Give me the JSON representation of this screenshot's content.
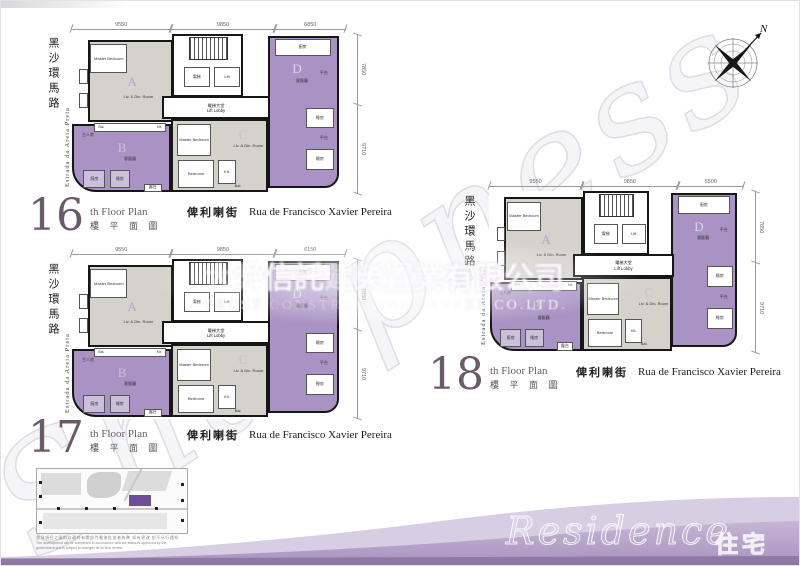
{
  "watermark": {
    "script_text": "Sharpness",
    "company_cn_pre": "大舜",
    "company_cn_a": "信託",
    "company_cn_mid": "建榮置業",
    "company_cn_b": "有限公司",
    "company_en_a": "TRUST",
    "company_en_mid": " CONSTRUCTION INVE",
    "company_en_b": "ST CO.LTD."
  },
  "compass": {
    "north_label": "N"
  },
  "plan_labels": {
    "unit_a": "A",
    "unit_b": "B",
    "unit_c": "C",
    "unit_d": "D",
    "master_bedroom": "Master Bedroom",
    "liv_din": "Liv. & Din. Room",
    "bedroom": "Bedroom",
    "kitchen_abbr": "Kit.",
    "balcony_abbr": "Bal.",
    "lift_cn": "電梯",
    "lift_en": "Lift",
    "lift_lobby_cn": "電梯大堂",
    "lift_lobby_en": "Lift Lobby",
    "living_dining_cn": "客飯廳",
    "master_room_cn": "主人房",
    "bedroom_cn": "睡房",
    "kitchen_cn": "廚房",
    "terrace_cn": "平台",
    "balcony_cn": "露台"
  },
  "floors": [
    {
      "number": "16",
      "suffix": "th Floor Plan",
      "title_cn": "樓 平 面 圖",
      "road_cn": "黑沙環馬路",
      "road_pt": "Estrada da Areia Preta",
      "street_cn": "俾利喇街",
      "street_pt": "Rua de Francisco Xavier Pereira",
      "dims_top": [
        "9550",
        "9850",
        "6850"
      ],
      "dims_right": [
        "7850",
        "9710"
      ]
    },
    {
      "number": "17",
      "suffix": "th Floor Plan",
      "title_cn": "樓 平 面 圖",
      "road_cn": "黑沙環馬路",
      "road_pt": "Estrada da Areia Preta",
      "street_cn": "俾利喇街",
      "street_pt": "Rua de Francisco Xavier Pereira",
      "dims_top": [
        "9550",
        "9850",
        "6150"
      ],
      "dims_right": [
        "7850",
        "9710"
      ]
    },
    {
      "number": "18",
      "suffix": "th Floor Plan",
      "title_cn": "樓 平 面 圖",
      "road_cn": "黑沙環馬路",
      "road_pt": "Estrada da Areia Preta",
      "street_cn": "俾利喇街",
      "street_pt": "Rua de Francisco Xavier Pereira",
      "dims_top": [
        "9550",
        "9850",
        "5500"
      ],
      "dims_right": [
        "7850",
        "9710"
      ]
    }
  ],
  "site_map": {
    "disclaimer_cn": "發展項目之圖則以政府有關部門最後批准者為準 如有更改 恕不另行通知",
    "disclaimer_en1": "The development will be completed in accordance with the features approved by the",
    "disclaimer_en2": "government and is subject to changes till its final review."
  },
  "footer": {
    "residence_en": "Residence",
    "residence_cn": "住宅"
  }
}
